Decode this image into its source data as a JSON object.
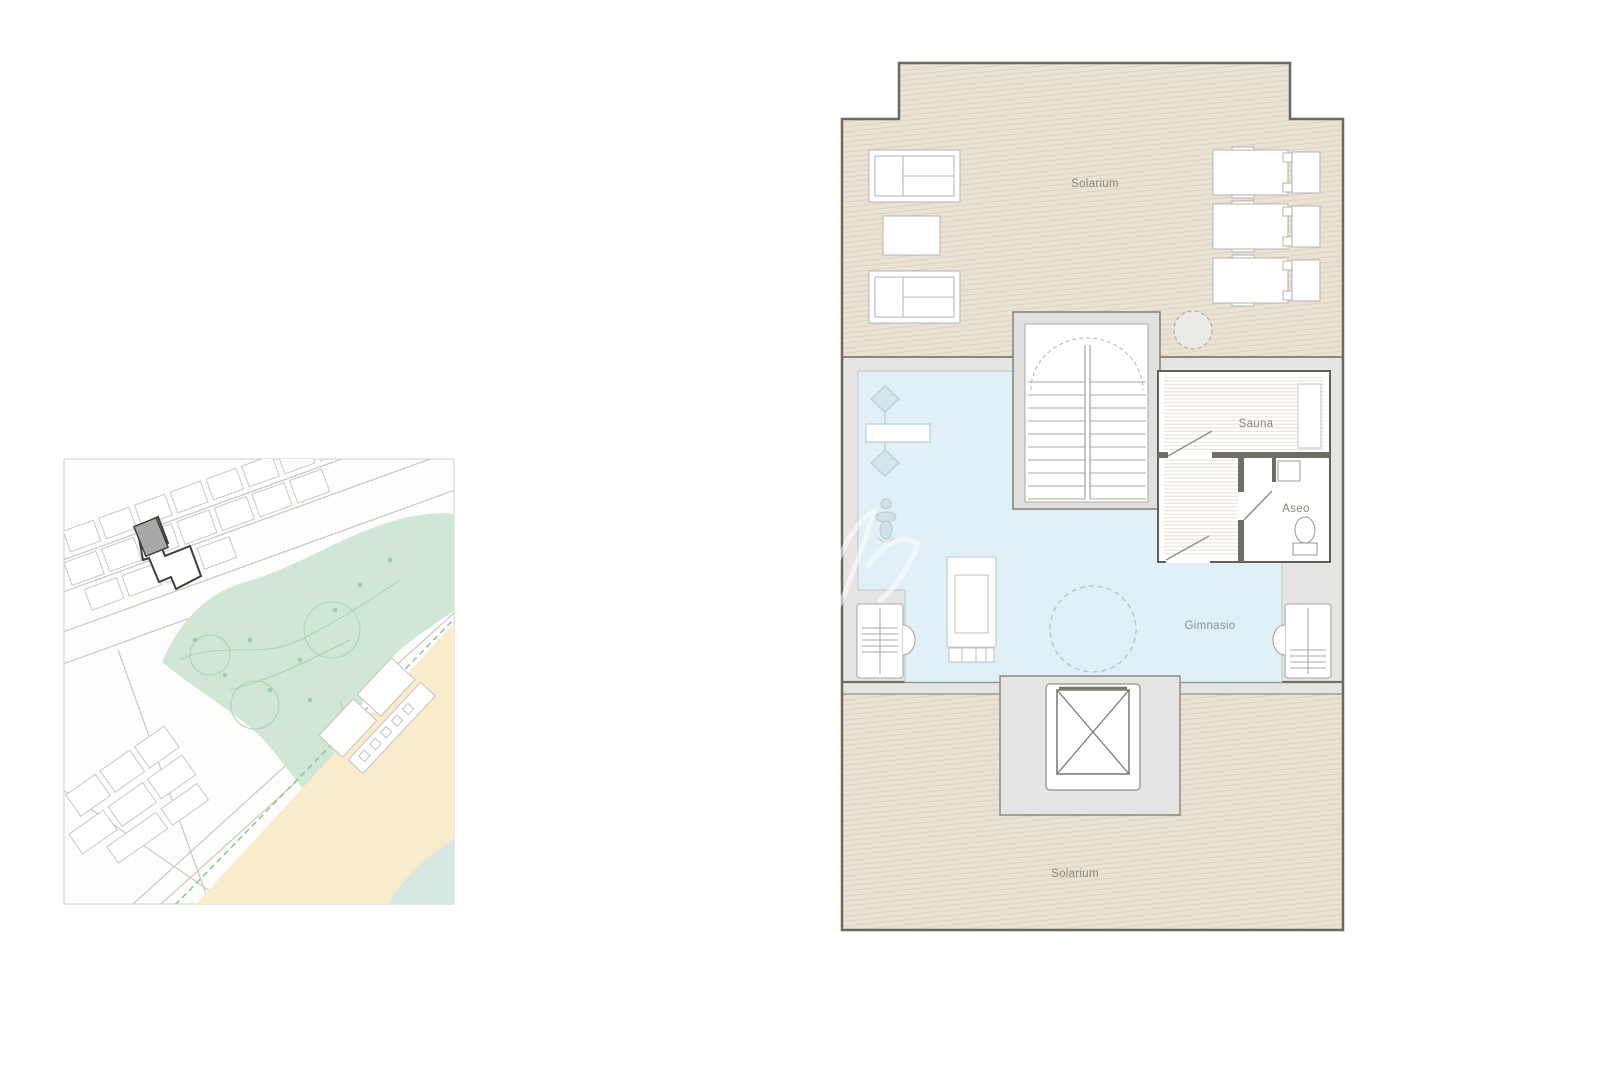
{
  "floor_plan": {
    "labels": {
      "solarium_top": "Solarium",
      "sauna": "Sauna",
      "aseo": "Aseo",
      "gimnasio": "Gimnasio",
      "solarium_bottom": "Solarium"
    },
    "colors": {
      "wall": "#6a695f",
      "solarium_fill": "#eae2d4",
      "solarium_hatch": "#ddd2c0",
      "circulation_fill": "#e5e5e3",
      "gym_fill": "#e0f0f6",
      "room_fill": "#ffffff",
      "label_color": "#8a857b",
      "gym_label_color": "#7e8f98"
    },
    "icons": [
      "sun-lounger-icon",
      "side-table-icon",
      "stairs-icon",
      "spa-circle-icon",
      "sauna-bench-icon",
      "sink-icon",
      "toilet-icon",
      "door-swing-icon",
      "bench-press-icon",
      "person-icon",
      "treadmill-icon",
      "weight-machine-icon",
      "elevator-icon",
      "dashed-circle-icon"
    ]
  },
  "site_map": {
    "colors": {
      "park_green": "#cfe7d4",
      "sand": "#f8ecca",
      "water": "#d6e8e3",
      "street": "#c8c8c5",
      "highlight_plot_fill": "#a9a8a6",
      "highlight_plot_outline": "#3f3e3a"
    },
    "features": [
      "street-grid",
      "buildings",
      "park",
      "beach",
      "sea",
      "promenade",
      "highlighted-building-plot"
    ]
  },
  "watermark": {
    "present": true
  }
}
